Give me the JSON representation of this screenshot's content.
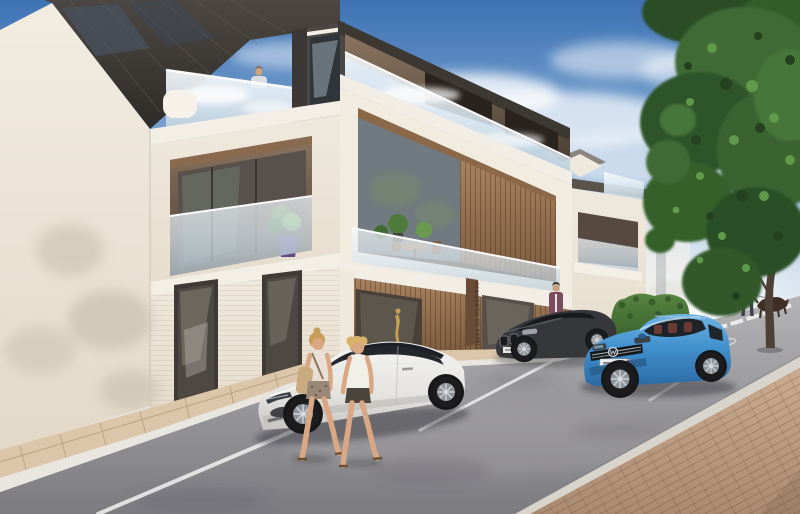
{
  "scene": {
    "kind": "architectural exterior render",
    "summary": "Modern three-storey apartment residence with glass balconies and wood-slat facade, street parking in front, pedestrians and a large tree at right",
    "lighting": "sunny afternoon, hazy horizon"
  },
  "building": {
    "style": "contemporary white brick with dark sloped roofs, glass balustrades and vertical wood slats",
    "floors": 3,
    "sign": {
      "text": "RESIDENTIE DE KAPELLE",
      "orientation": "vertical",
      "location": "wood panel beside ground-floor entrance"
    },
    "features": [
      "rooftop terrace with reflective glass balustrade",
      "dark dormer volumes",
      "recessed balconies with potted plants",
      "terrace with table and chairs",
      "wood-slat storefront with gold statue in display window",
      "trimmed hedge at right wing"
    ]
  },
  "vehicles": [
    {
      "id": "white-sedan",
      "description": "white electric sedan parked in foreground bay, facing left",
      "color": "#e9e8e5"
    },
    {
      "id": "dark-sedan",
      "description": "dark grey sedan parked behind the white sedan",
      "color": "#36373b"
    },
    {
      "id": "blue-suv",
      "description": "bright blue SUV with chrome grille and VW roundel",
      "color": "#4292cf",
      "license_plate": "white plate, characters illegible, red tab at right"
    }
  ],
  "people": [
    {
      "id": "woman-with-bag",
      "description": "blonde woman, light tank top, patterned shorts, beige shoulder bag, walking right past the white sedan"
    },
    {
      "id": "woman-right",
      "description": "blonde woman, white tank top, dark shorts, walking beside her"
    },
    {
      "id": "man-at-door",
      "description": "man in plum jacket at the entrance glass door"
    },
    {
      "id": "dog-walker",
      "description": "man in grey t-shirt and dark trousers walking a brown dog across the street"
    },
    {
      "id": "rooftop-man",
      "description": "man standing behind the rooftop glass balustrade"
    }
  ],
  "environment": {
    "tree": "large leafy deciduous tree on right edge",
    "hedge": "trimmed green hedge beside right wing",
    "road_markings": [
      "white parking bay lines",
      "dashed pedestrian crossing",
      "faint oval marking"
    ],
    "paving": [
      "tan brick sidewalk strip along facade",
      "herringbone brick pavement at bottom right",
      "light curb stones"
    ],
    "sky": "blue sky, soft white clouds, white haze at horizon"
  },
  "palette": {
    "sky_top": "#3d72b4",
    "sky_horizon": "#eef2f3",
    "cloud": "#ffffff",
    "facade_light": "#f0eadf",
    "facade_shadow": "#e2d9c8",
    "trim_white": "#f4efe6",
    "roof_dark": "#3a3531",
    "wood_mid": "#a8825f",
    "wood_dark": "#7c5b3f",
    "glass_tint": "#dce8f0",
    "interior_dark": "#4a3e33",
    "hedge_green": "#47703a",
    "tree_green_dark": "#2a4d26",
    "tree_green_mid": "#3f6b35",
    "tree_green_light": "#5f9a4a",
    "trunk_brown": "#4e4034",
    "asphalt": "#97969a",
    "paver_tan": "#c0a287",
    "paver_strip": "#dcc6aa",
    "curb": "#e9e6df",
    "marking_white": "#ffffff",
    "car_white": "#e9e8e5",
    "car_dark": "#36373b",
    "car_blue": "#4292cf",
    "skin": "#d9a783",
    "hair_blonde": "#c9a05a",
    "bag_tan": "#c8aa7e",
    "jacket_plum": "#7b4c60",
    "shirt_grey": "#d6d6d2",
    "dog_brown": "#3f2e24",
    "statue_gold": "#c79e52",
    "pot_purple": "#5b4a7d"
  }
}
